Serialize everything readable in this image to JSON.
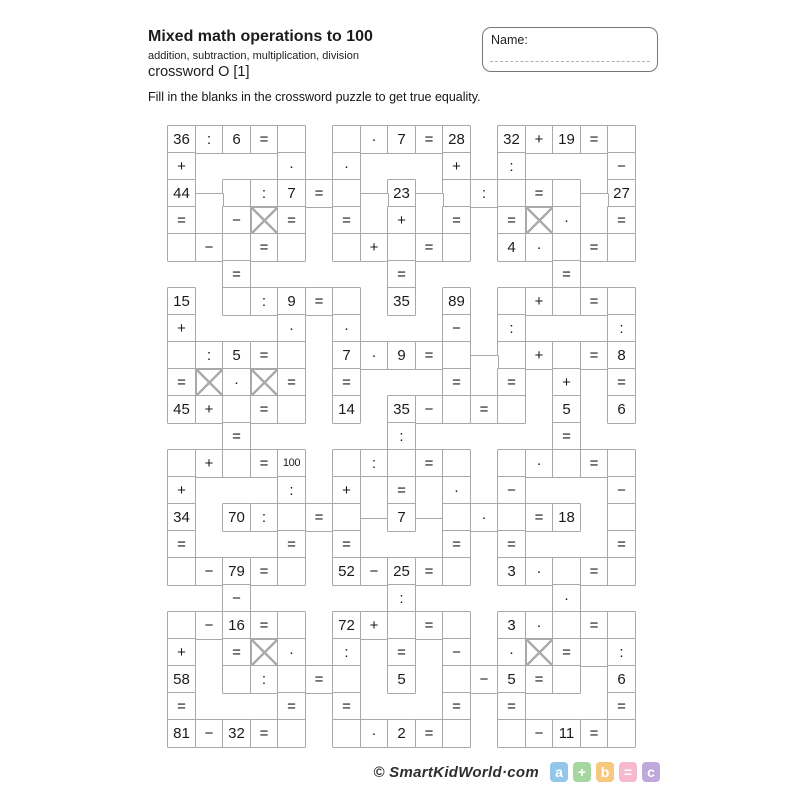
{
  "header": {
    "title": "Mixed math operations to 100",
    "subtitle": "addition, subtraction, multiplication, division",
    "crossword_label": "crossword O [1]"
  },
  "name_box": {
    "label": "Name:"
  },
  "instruction": "Fill in the blanks in the crossword puzzle to get true equality.",
  "grid": {
    "cols": 17,
    "rows": 23,
    "cell_w": 27.5,
    "cell_h": 27,
    "blocked_marker": "X",
    "operators": [
      "+",
      "−",
      "·",
      ":",
      "="
    ],
    "rows_data": [
      {
        "r": 0,
        "cells": [
          [
            0,
            "36"
          ],
          [
            1,
            ":"
          ],
          [
            2,
            "6"
          ],
          [
            3,
            "="
          ],
          [
            4,
            ""
          ],
          [
            6,
            ""
          ],
          [
            7,
            "·"
          ],
          [
            8,
            "7"
          ],
          [
            9,
            "="
          ],
          [
            10,
            "28"
          ],
          [
            12,
            "32"
          ],
          [
            13,
            "+"
          ],
          [
            14,
            "19"
          ],
          [
            15,
            "="
          ],
          [
            16,
            ""
          ]
        ]
      },
      {
        "r": 1,
        "cells": [
          [
            0,
            "+"
          ],
          [
            4,
            "·"
          ],
          [
            6,
            "·"
          ],
          [
            10,
            "+"
          ],
          [
            12,
            ":"
          ],
          [
            16,
            "−"
          ]
        ]
      },
      {
        "r": 2,
        "cells": [
          [
            0,
            "44"
          ],
          [
            2,
            ""
          ],
          [
            3,
            ":"
          ],
          [
            4,
            "7"
          ],
          [
            5,
            "="
          ],
          [
            6,
            ""
          ],
          [
            8,
            "23"
          ],
          [
            10,
            ""
          ],
          [
            11,
            ":"
          ],
          [
            12,
            ""
          ],
          [
            13,
            "="
          ],
          [
            14,
            ""
          ],
          [
            16,
            "27"
          ]
        ]
      },
      {
        "r": 3,
        "cells": [
          [
            0,
            "="
          ],
          [
            1,
            "",
            "up"
          ],
          [
            2,
            "−"
          ],
          [
            3,
            "X"
          ],
          [
            4,
            "="
          ],
          [
            6,
            "="
          ],
          [
            7,
            "",
            "up"
          ],
          [
            8,
            "+"
          ],
          [
            9,
            "",
            "up"
          ],
          [
            10,
            "="
          ],
          [
            12,
            "="
          ],
          [
            13,
            "X"
          ],
          [
            14,
            "·"
          ],
          [
            15,
            "",
            "up"
          ],
          [
            16,
            "="
          ]
        ]
      },
      {
        "r": 4,
        "cells": [
          [
            0,
            ""
          ],
          [
            1,
            "−"
          ],
          [
            2,
            ""
          ],
          [
            3,
            "="
          ],
          [
            4,
            ""
          ],
          [
            6,
            ""
          ],
          [
            7,
            "+"
          ],
          [
            8,
            ""
          ],
          [
            9,
            "="
          ],
          [
            10,
            ""
          ],
          [
            12,
            "4"
          ],
          [
            13,
            "·"
          ],
          [
            14,
            ""
          ],
          [
            15,
            "="
          ],
          [
            16,
            ""
          ]
        ]
      },
      {
        "r": 5,
        "cells": [
          [
            2,
            "="
          ],
          [
            8,
            "="
          ],
          [
            14,
            "="
          ]
        ]
      },
      {
        "r": 6,
        "cells": [
          [
            0,
            "15"
          ],
          [
            2,
            ""
          ],
          [
            3,
            ":"
          ],
          [
            4,
            "9"
          ],
          [
            5,
            "="
          ],
          [
            6,
            ""
          ],
          [
            8,
            "35"
          ],
          [
            10,
            "89"
          ],
          [
            12,
            ""
          ],
          [
            13,
            "+"
          ],
          [
            14,
            ""
          ],
          [
            15,
            "="
          ],
          [
            16,
            ""
          ]
        ]
      },
      {
        "r": 7,
        "cells": [
          [
            0,
            "+"
          ],
          [
            4,
            "·"
          ],
          [
            6,
            "·"
          ],
          [
            10,
            "−"
          ],
          [
            12,
            ":"
          ],
          [
            16,
            ":"
          ]
        ]
      },
      {
        "r": 8,
        "cells": [
          [
            0,
            ""
          ],
          [
            1,
            ":"
          ],
          [
            2,
            "5"
          ],
          [
            3,
            "="
          ],
          [
            4,
            ""
          ],
          [
            6,
            "7"
          ],
          [
            7,
            "·"
          ],
          [
            8,
            "9"
          ],
          [
            9,
            "="
          ],
          [
            10,
            ""
          ],
          [
            12,
            ""
          ],
          [
            13,
            "+"
          ],
          [
            14,
            ""
          ],
          [
            15,
            "="
          ],
          [
            16,
            "8"
          ]
        ]
      },
      {
        "r": 9,
        "cells": [
          [
            0,
            "="
          ],
          [
            1,
            "X"
          ],
          [
            2,
            "·"
          ],
          [
            3,
            "X"
          ],
          [
            4,
            "="
          ],
          [
            6,
            "="
          ],
          [
            10,
            "="
          ],
          [
            11,
            "",
            "up"
          ],
          [
            12,
            "="
          ],
          [
            14,
            "+"
          ],
          [
            16,
            "="
          ]
        ]
      },
      {
        "r": 10,
        "cells": [
          [
            0,
            "45"
          ],
          [
            1,
            "+"
          ],
          [
            2,
            ""
          ],
          [
            3,
            "="
          ],
          [
            4,
            ""
          ],
          [
            6,
            "14"
          ],
          [
            8,
            "35"
          ],
          [
            9,
            "−"
          ],
          [
            10,
            ""
          ],
          [
            11,
            "="
          ],
          [
            12,
            ""
          ],
          [
            14,
            "5"
          ],
          [
            16,
            "6"
          ]
        ]
      },
      {
        "r": 11,
        "cells": [
          [
            2,
            "="
          ],
          [
            8,
            ":"
          ],
          [
            14,
            "="
          ]
        ]
      },
      {
        "r": 12,
        "cells": [
          [
            0,
            ""
          ],
          [
            1,
            "+"
          ],
          [
            2,
            ""
          ],
          [
            3,
            "="
          ],
          [
            4,
            "100"
          ],
          [
            6,
            ""
          ],
          [
            7,
            ":"
          ],
          [
            8,
            ""
          ],
          [
            9,
            "="
          ],
          [
            10,
            ""
          ],
          [
            12,
            ""
          ],
          [
            13,
            "·"
          ],
          [
            14,
            ""
          ],
          [
            15,
            "="
          ],
          [
            16,
            ""
          ]
        ]
      },
      {
        "r": 13,
        "cells": [
          [
            0,
            "+"
          ],
          [
            4,
            ":"
          ],
          [
            6,
            "+"
          ],
          [
            7,
            "",
            "down"
          ],
          [
            8,
            "="
          ],
          [
            9,
            "",
            "down"
          ],
          [
            10,
            "·"
          ],
          [
            12,
            "−"
          ],
          [
            16,
            "−"
          ]
        ]
      },
      {
        "r": 14,
        "cells": [
          [
            0,
            "34"
          ],
          [
            2,
            "70"
          ],
          [
            3,
            ":"
          ],
          [
            4,
            ""
          ],
          [
            5,
            "="
          ],
          [
            6,
            ""
          ],
          [
            8,
            "7"
          ],
          [
            10,
            ""
          ],
          [
            11,
            "·"
          ],
          [
            12,
            ""
          ],
          [
            13,
            "="
          ],
          [
            14,
            "18"
          ],
          [
            16,
            ""
          ]
        ]
      },
      {
        "r": 15,
        "cells": [
          [
            0,
            "="
          ],
          [
            4,
            "="
          ],
          [
            6,
            "="
          ],
          [
            10,
            "="
          ],
          [
            12,
            "="
          ],
          [
            16,
            "="
          ]
        ]
      },
      {
        "r": 16,
        "cells": [
          [
            0,
            ""
          ],
          [
            1,
            "−"
          ],
          [
            2,
            "79"
          ],
          [
            3,
            "="
          ],
          [
            4,
            ""
          ],
          [
            6,
            "52"
          ],
          [
            7,
            "−"
          ],
          [
            8,
            "25"
          ],
          [
            9,
            "="
          ],
          [
            10,
            ""
          ],
          [
            12,
            "3"
          ],
          [
            13,
            "·"
          ],
          [
            14,
            ""
          ],
          [
            15,
            "="
          ],
          [
            16,
            ""
          ]
        ]
      },
      {
        "r": 17,
        "cells": [
          [
            2,
            "−"
          ],
          [
            8,
            ":"
          ],
          [
            14,
            "·"
          ]
        ]
      },
      {
        "r": 18,
        "cells": [
          [
            0,
            ""
          ],
          [
            1,
            "−"
          ],
          [
            2,
            "16"
          ],
          [
            3,
            "="
          ],
          [
            4,
            ""
          ],
          [
            6,
            "72"
          ],
          [
            7,
            "+"
          ],
          [
            8,
            ""
          ],
          [
            9,
            "="
          ],
          [
            10,
            ""
          ],
          [
            12,
            "3"
          ],
          [
            13,
            "·"
          ],
          [
            14,
            ""
          ],
          [
            15,
            "="
          ],
          [
            16,
            ""
          ]
        ]
      },
      {
        "r": 19,
        "cells": [
          [
            0,
            "+"
          ],
          [
            2,
            "="
          ],
          [
            3,
            "X"
          ],
          [
            4,
            "·"
          ],
          [
            6,
            ":"
          ],
          [
            8,
            "="
          ],
          [
            10,
            "−"
          ],
          [
            12,
            "·"
          ],
          [
            13,
            "X"
          ],
          [
            14,
            "="
          ],
          [
            15,
            ""
          ],
          [
            16,
            ":"
          ]
        ]
      },
      {
        "r": 20,
        "cells": [
          [
            0,
            "58"
          ],
          [
            2,
            ""
          ],
          [
            3,
            ":"
          ],
          [
            4,
            ""
          ],
          [
            5,
            "="
          ],
          [
            6,
            ""
          ],
          [
            8,
            "5"
          ],
          [
            10,
            ""
          ],
          [
            11,
            "−"
          ],
          [
            12,
            "5"
          ],
          [
            13,
            "="
          ],
          [
            14,
            ""
          ],
          [
            16,
            "6"
          ]
        ]
      },
      {
        "r": 21,
        "cells": [
          [
            0,
            "="
          ],
          [
            4,
            "="
          ],
          [
            6,
            "="
          ],
          [
            10,
            "="
          ],
          [
            12,
            "="
          ],
          [
            16,
            "="
          ]
        ]
      },
      {
        "r": 22,
        "cells": [
          [
            0,
            "81"
          ],
          [
            1,
            "−"
          ],
          [
            2,
            "32"
          ],
          [
            3,
            "="
          ],
          [
            4,
            ""
          ],
          [
            6,
            ""
          ],
          [
            7,
            "·"
          ],
          [
            8,
            "2"
          ],
          [
            9,
            "="
          ],
          [
            10,
            ""
          ],
          [
            12,
            ""
          ],
          [
            13,
            "−"
          ],
          [
            14,
            "11"
          ],
          [
            15,
            "="
          ],
          [
            16,
            ""
          ]
        ]
      }
    ]
  },
  "footer": {
    "brand": "© SmartKidWorld·com",
    "badges": [
      {
        "label": "a",
        "color": "#93c7ea"
      },
      {
        "label": "+",
        "color": "#a6d7a1"
      },
      {
        "label": "b",
        "color": "#f7c97e"
      },
      {
        "label": "=",
        "color": "#f5bacc"
      },
      {
        "label": "c",
        "color": "#bfa9dc"
      }
    ]
  }
}
